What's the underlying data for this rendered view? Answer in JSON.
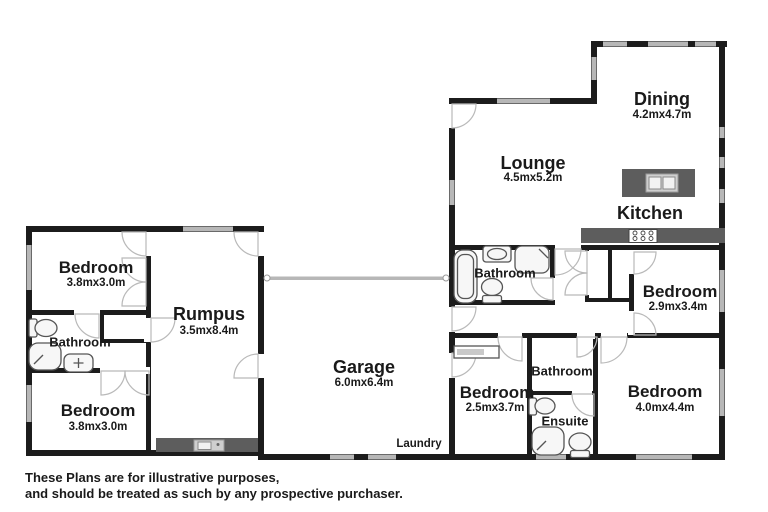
{
  "plan": {
    "title": "Residential floor plan",
    "disclaimer_line1": "These Plans are for illustrative purposes,",
    "disclaimer_line2": "and should be treated as such by any prospective purchaser.",
    "rooms": {
      "dining": {
        "label": "Dining",
        "dims": "4.2mx4.7m"
      },
      "lounge": {
        "label": "Lounge",
        "dims": "4.5mx5.2m"
      },
      "kitchen": {
        "label": "Kitchen"
      },
      "bedroom_top_left": {
        "label": "Bedroom",
        "dims": "3.8mx3.0m"
      },
      "bathroom_left": {
        "label": "Bathroom"
      },
      "bedroom_bottom_left": {
        "label": "Bedroom",
        "dims": "3.8mx3.0m"
      },
      "rumpus": {
        "label": "Rumpus",
        "dims": "3.5mx8.4m"
      },
      "garage": {
        "label": "Garage",
        "dims": "6.0mx6.4m"
      },
      "bathroom_main": {
        "label": "Bathroom"
      },
      "bedroom_right": {
        "label": "Bedroom",
        "dims": "2.9mx3.4m"
      },
      "bedroom_mid": {
        "label": "Bedroom",
        "dims": "2.5mx3.7m"
      },
      "bathroom_bottom": {
        "label": "Bathroom"
      },
      "ensuite": {
        "label": "Ensuite"
      },
      "bedroom_bottom_right": {
        "label": "Bedroom",
        "dims": "4.0mx4.4m"
      },
      "laundry": {
        "label": "Laundry"
      }
    },
    "colors": {
      "wall": "#1c1c1c",
      "counter": "#5d5d5d",
      "window": "#b7b7b7",
      "door_arc": "#b9b9b9",
      "fixture_stroke": "#555555",
      "fixture_fill": "#f7f7f7",
      "text": "#1a1a1a",
      "background": "#ffffff"
    }
  }
}
